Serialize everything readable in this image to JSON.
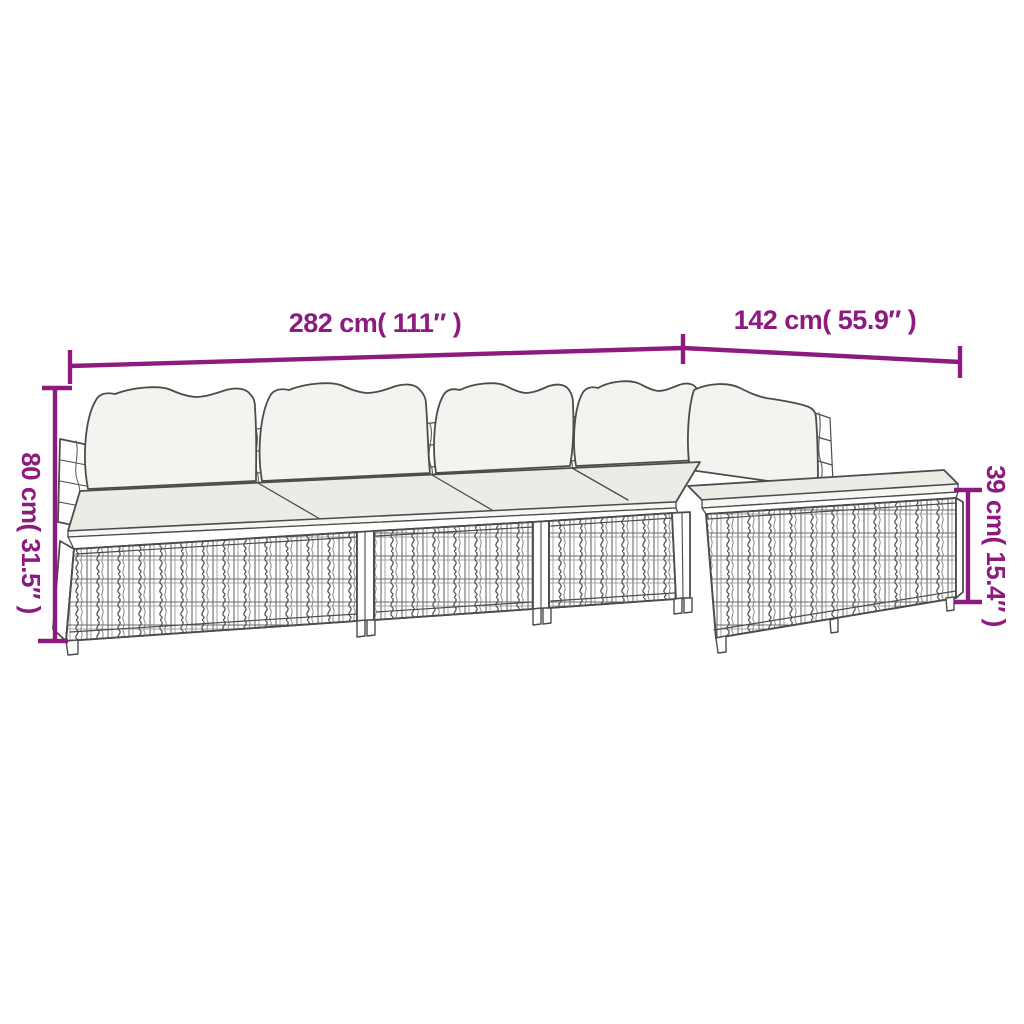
{
  "page": {
    "background": "#FFFFFF"
  },
  "colors": {
    "dimension_accent": "#8D1A7E",
    "line_art_stroke": "#4C4C4C",
    "seat_cushion_fill": "#EDEBE6",
    "back_cushion_fill": "#F4F3F0",
    "base_fill": "#FFFFFF"
  },
  "diagram": {
    "type": "product-dimension-diagram",
    "dimensions": {
      "width": {
        "label": "282 cm( 111″ )",
        "cm": 282,
        "inch": 111
      },
      "depth": {
        "label": "142 cm( 55.9″ )",
        "cm": 142,
        "inch": 55.9
      },
      "height": {
        "label": "80 cm( 31.5″ )",
        "cm": 80,
        "inch": 31.5
      },
      "footstool_height": {
        "label": "39 cm( 15.4″ )",
        "cm": 39,
        "inch": 15.4
      }
    }
  }
}
